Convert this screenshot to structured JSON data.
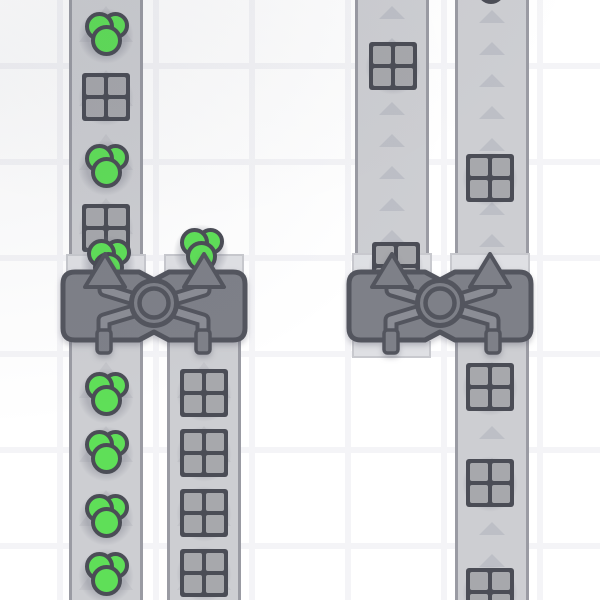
{
  "scene": {
    "canvas": {
      "width": 600,
      "height": 600
    },
    "grid": {
      "cell": 96,
      "line_width": 6,
      "origin_x": 60,
      "origin_y": 66
    },
    "colors": {
      "background": "#ffffff",
      "grid_line": "#f4f4f7",
      "belt": "#cdced2",
      "belt_edge": "#9a9ba3",
      "arrow_small": "#bdbfc6",
      "arrow_large": "#c2c3c9",
      "pad": "#dfe0e4",
      "pad_edge": "#c8c9ce",
      "machine_body": "#7e8088",
      "machine_outline": "#53555e",
      "machine_band": "#8b8d95",
      "item_outline": "#4b4d56",
      "berry_green": "#5fdf58",
      "window_gray": "#a7a8ac",
      "item_shadow": "rgba(125,127,140,0.36)",
      "partial_circle_gray": "#c6c7cc"
    },
    "arrow_sizes": {
      "large": {
        "w": 54,
        "h": 36
      },
      "small": {
        "w": 26,
        "h": 13
      }
    },
    "belts": [
      {
        "id": "belt-left-main",
        "x": 69,
        "width": 74,
        "y1": 0,
        "y2": 600,
        "arrow_style": "large",
        "arrow_gap": 64,
        "arrow_ranges": [
          [
            6,
            250
          ],
          [
            362,
            600
          ]
        ]
      },
      {
        "id": "belt-left-out",
        "x": 167,
        "width": 74,
        "y1": 300,
        "y2": 600,
        "arrow_style": "large",
        "arrow_gap": 64,
        "arrow_ranges": [
          [
            362,
            600
          ]
        ]
      },
      {
        "id": "belt-right-in",
        "x": 355,
        "width": 74,
        "y1": 0,
        "y2": 330,
        "arrow_style": "small",
        "arrow_gap": 32,
        "arrow_ranges": [
          [
            6,
            250
          ]
        ]
      },
      {
        "id": "belt-right-main",
        "x": 455,
        "width": 74,
        "y1": 0,
        "y2": 600,
        "arrow_style": "small",
        "arrow_gap": 32,
        "arrow_ranges": [
          [
            10,
            250
          ],
          [
            362,
            598
          ]
        ]
      }
    ],
    "pads": [
      {
        "x": 66,
        "y": 254,
        "w": 80,
        "h": 23
      },
      {
        "x": 164,
        "y": 254,
        "w": 80,
        "h": 23
      },
      {
        "x": 352,
        "y": 253,
        "w": 80,
        "h": 24
      },
      {
        "x": 450,
        "y": 253,
        "w": 80,
        "h": 24
      }
    ],
    "stubs": [
      {
        "x": 352,
        "y": 341,
        "w": 79,
        "h": 17
      }
    ],
    "items": [
      {
        "type": "berries",
        "x": 106,
        "y": 35
      },
      {
        "type": "window",
        "x": 106,
        "y": 97
      },
      {
        "type": "berries",
        "x": 106,
        "y": 167
      },
      {
        "type": "window",
        "x": 106,
        "y": 228
      },
      {
        "type": "berries",
        "x": 108,
        "y": 262
      },
      {
        "type": "berries",
        "x": 106,
        "y": 395
      },
      {
        "type": "berries",
        "x": 106,
        "y": 453
      },
      {
        "type": "berries",
        "x": 106,
        "y": 517
      },
      {
        "type": "berries",
        "x": 106,
        "y": 575
      },
      {
        "type": "berries",
        "x": 201,
        "y": 251
      },
      {
        "type": "window",
        "x": 204,
        "y": 393
      },
      {
        "type": "window",
        "x": 204,
        "y": 453
      },
      {
        "type": "window",
        "x": 204,
        "y": 513
      },
      {
        "type": "window",
        "x": 204,
        "y": 573
      },
      {
        "type": "window",
        "x": 393,
        "y": 66
      },
      {
        "type": "window",
        "x": 396,
        "y": 266
      },
      {
        "type": "circle",
        "x": 491,
        "y": -10
      },
      {
        "type": "window",
        "x": 490,
        "y": 178
      },
      {
        "type": "window",
        "x": 490,
        "y": 387
      },
      {
        "type": "window",
        "x": 490,
        "y": 483
      },
      {
        "type": "window",
        "x": 490,
        "y": 592
      }
    ],
    "machines": [
      {
        "id": "balancer-left",
        "x": 63,
        "y": 272,
        "w": 182,
        "h": 68,
        "inputs": [
          105,
          204
        ],
        "outputs": [
          104,
          203
        ]
      },
      {
        "id": "balancer-right",
        "x": 349,
        "y": 272,
        "w": 182,
        "h": 68,
        "inputs": [
          392,
          490
        ],
        "outputs": [
          391,
          493
        ]
      }
    ]
  }
}
